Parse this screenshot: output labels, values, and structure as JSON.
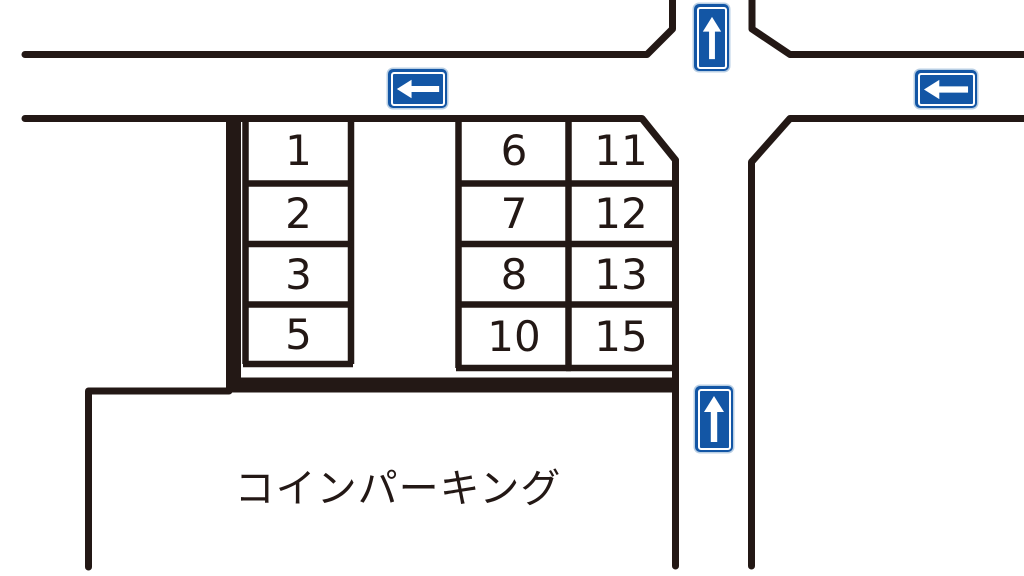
{
  "lot": {
    "name": "コインパーキング"
  },
  "colors": {
    "line": "#231815",
    "sign_blue": "#1356a5",
    "sign_trim": "#b9cfe4",
    "background": "#ffffff"
  },
  "parking": {
    "columns": [
      {
        "id": "left-column",
        "spaces": [
          {
            "label": "1"
          },
          {
            "label": "2"
          },
          {
            "label": "3"
          },
          {
            "label": "5"
          }
        ]
      },
      {
        "id": "middle-column",
        "spaces": [
          {
            "label": "6"
          },
          {
            "label": "7"
          },
          {
            "label": "8"
          },
          {
            "label": "10"
          }
        ]
      },
      {
        "id": "right-column",
        "spaces": [
          {
            "label": "11"
          },
          {
            "label": "12"
          },
          {
            "label": "13"
          },
          {
            "label": "15"
          }
        ]
      }
    ]
  },
  "signs": [
    {
      "id": "one-way-up-top",
      "direction": "up"
    },
    {
      "id": "one-way-left-center",
      "direction": "left"
    },
    {
      "id": "one-way-left-right",
      "direction": "left"
    },
    {
      "id": "one-way-up-side",
      "direction": "up"
    }
  ]
}
